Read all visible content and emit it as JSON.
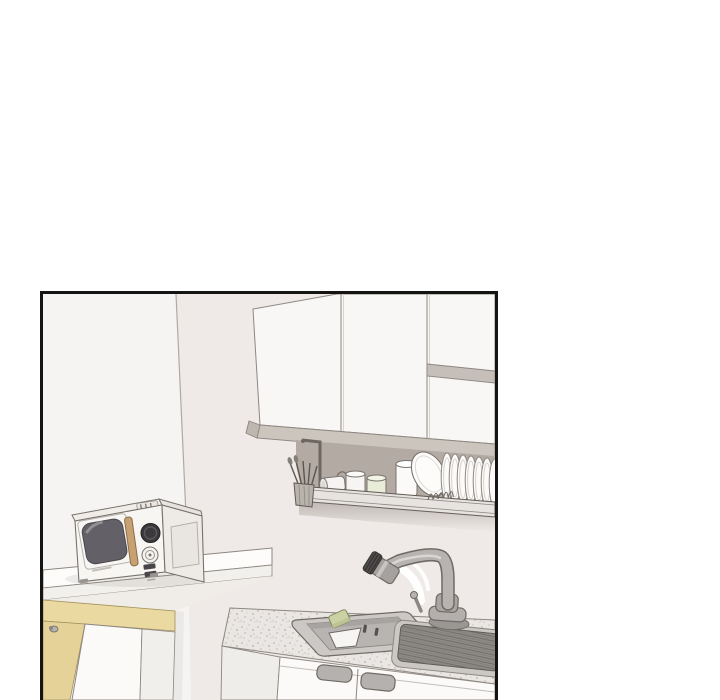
{
  "page": {
    "background_color": "#ffffff"
  },
  "panel": {
    "type": "webtoon-comic-panel",
    "left_px": 40,
    "top_px": 291,
    "width_px": 458,
    "height_px": 409,
    "border_color": "#141414",
    "border_px": 3,
    "visible_text": ""
  },
  "scene": {
    "description": "Line-art illustration of a small kitchen: white upper cabinets with an open shelf, an under-cabinet drying rack holding utensils, cups, a jar, a tilted bowl and plates, a retro microwave on a white counter above a yellow-trimmed lower cabinet, and a sink unit with speckled countertop, inset basin with sponge, gooseneck faucet and ribbed draining board.",
    "colors": {
      "wall_left": "#f6f4f3",
      "wall_right": "#efeae7",
      "cabinet_face": "#f8f7f5",
      "cabinet_trim": "#ccc5be",
      "soffit_shadow": "#b3aaa4",
      "rack_rail": "#e6e3e0",
      "plate_white": "#fcfbfa",
      "cup_green": "#e9ecd8",
      "microwave_body": "#f8f6f3",
      "microwave_side": "#eeebe7",
      "microwave_window": "#636167",
      "microwave_handle": "#c8a172",
      "counter_white": "#fdfcfb",
      "unit_accent_yellow": "#ead9a1",
      "unit_accent_yellow_dark": "#e4d298",
      "countertop_gray": "#e9e6e3",
      "sink_rim": "#ccc8c5",
      "sink_basin": "#b8b4b1",
      "drainboard_tray": "#cbc7c3",
      "drainboard_dark": "#8f8b87",
      "door_handle_gray": "#b5b1ae",
      "faucet_metal": "#b7b3b0",
      "sponge_green": "#ccd1a3",
      "line_color": "#6f6a66"
    },
    "objects": [
      {
        "name": "upper-cabinets",
        "label": "white upper cabinet doors"
      },
      {
        "name": "open-shelf",
        "label": "open shelf section with divider board"
      },
      {
        "name": "dish-rack",
        "label": "under-cabinet dish drying rack"
      },
      {
        "name": "utensil-basket",
        "label": "utensil basket with cutlery"
      },
      {
        "name": "mug-on-side",
        "label": "mug lying on its side"
      },
      {
        "name": "white-cup",
        "label": "white cup"
      },
      {
        "name": "green-cup",
        "label": "pale green cup"
      },
      {
        "name": "white-jar",
        "label": "white jar"
      },
      {
        "name": "tilted-bowl",
        "label": "large tilted bowl"
      },
      {
        "name": "drying-plates",
        "label": "row of drying plates"
      },
      {
        "name": "microwave",
        "label": "retro microwave oven with window, handle and dials"
      },
      {
        "name": "microwave-counter",
        "label": "white counter shelf"
      },
      {
        "name": "lower-cabinet",
        "label": "lower cabinet with yellow trim and hinge knob"
      },
      {
        "name": "sink-unit",
        "label": "sink cabinet with speckled countertop and two handles"
      },
      {
        "name": "sink-basin",
        "label": "inset sink basin with dish and sponge"
      },
      {
        "name": "faucet",
        "label": "gooseneck faucet with lever"
      },
      {
        "name": "drainboard",
        "label": "ribbed draining board"
      }
    ]
  }
}
